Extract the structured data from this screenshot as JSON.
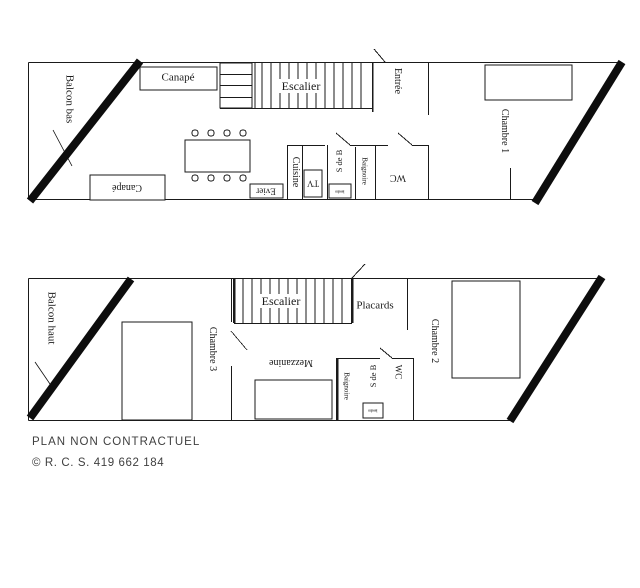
{
  "document": {
    "type": "apartment floor plans, two levels",
    "footer": {
      "line1": "PLAN NON CONTRACTUEL",
      "line2": "© R. C. S. 419 662 184"
    },
    "colors": {
      "line": "#1a1a1a",
      "label_text": "#1a1a1a",
      "footer_text": "#3f3f3f",
      "background": "#ffffff"
    }
  },
  "upper_floor": {
    "labels": {
      "balcon": "Balcon bas",
      "canape_top": "Canapé",
      "escalier": "Escalier",
      "entree": "Entrée",
      "chambre1": "Chambre 1",
      "cuisine": "Cuisine",
      "tv": "TV",
      "evier": "Evier",
      "s_de_b": "S de B",
      "baignoire": "Baignoire",
      "wc": "WC",
      "canape_bottom": "Canapé",
      "lavabo": "lavabo"
    }
  },
  "lower_floor": {
    "labels": {
      "balcon": "Balcon haut",
      "chambre3": "Chambre 3",
      "escalier": "Escalier",
      "placards": "Placards",
      "chambre2": "Chambre 2",
      "mezzanine": "Mezzanine",
      "baignoire": "Baignoire",
      "s_de_b": "S de B",
      "wc": "WC",
      "lavabo": "lavabo"
    }
  }
}
